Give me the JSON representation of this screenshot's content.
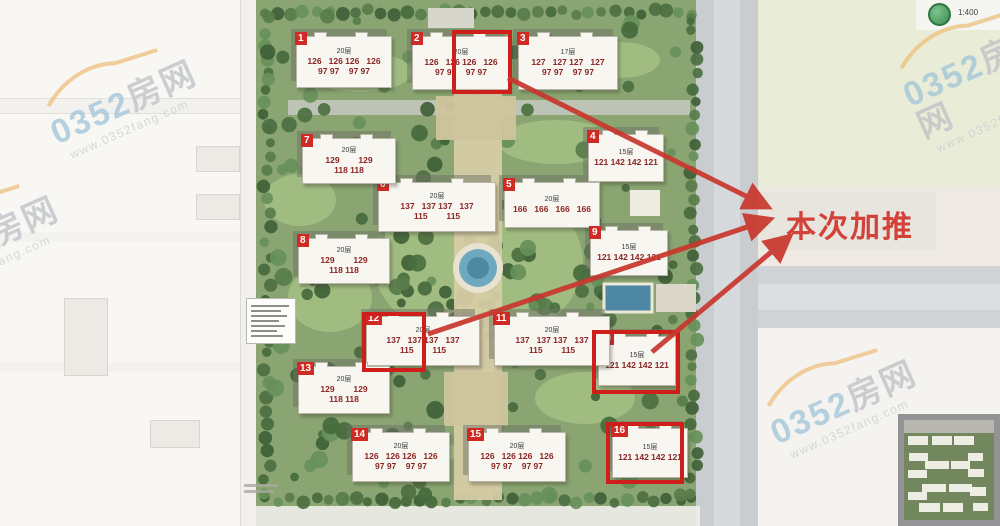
{
  "site_plan": {
    "promo_label": "本次加推",
    "scale_label": "1:400",
    "watermark": {
      "brand_prefix": "0352",
      "brand_suffix": "房网",
      "url": "www.0352fang.com"
    },
    "highlight_color": "#cf1f1a",
    "arrow_color": "#c8372d",
    "buildings": [
      {
        "no": "1",
        "floors": "20层",
        "areas1": "126   126 126   126",
        "areas2": "97 97    97 97",
        "x": 296,
        "y": 36,
        "w": 96,
        "h": 52,
        "highlight": false
      },
      {
        "no": "2",
        "floors": "20层",
        "areas1": "126   126 126   126",
        "areas2": "97 97    97 97",
        "x": 412,
        "y": 36,
        "w": 98,
        "h": 54,
        "highlight": true,
        "box": {
          "x": 452,
          "y": 30,
          "w": 60,
          "h": 64
        }
      },
      {
        "no": "3",
        "floors": "17层",
        "areas1": "127   127 127   127",
        "areas2": "97 97    97 97",
        "x": 518,
        "y": 36,
        "w": 100,
        "h": 54,
        "highlight": false
      },
      {
        "no": "4",
        "floors": "15层",
        "areas1": "121 142 142 121",
        "areas2": "",
        "x": 588,
        "y": 134,
        "w": 76,
        "h": 48,
        "highlight": false
      },
      {
        "no": "5",
        "floors": "20层",
        "areas1": "166   166   166   166",
        "areas2": "",
        "x": 504,
        "y": 182,
        "w": 96,
        "h": 46,
        "highlight": false
      },
      {
        "no": "6",
        "floors": "20层",
        "areas1": "137   137 137   137",
        "areas2": "115        115",
        "x": 378,
        "y": 182,
        "w": 118,
        "h": 50,
        "highlight": false
      },
      {
        "no": "7",
        "floors": "20层",
        "areas1": "129        129",
        "areas2": "118 118",
        "x": 302,
        "y": 138,
        "w": 94,
        "h": 46,
        "highlight": false
      },
      {
        "no": "8",
        "floors": "20层",
        "areas1": "129        129",
        "areas2": "118 118",
        "x": 298,
        "y": 238,
        "w": 92,
        "h": 46,
        "highlight": false
      },
      {
        "no": "9",
        "floors": "15层",
        "areas1": "121 142 142 121",
        "areas2": "",
        "x": 590,
        "y": 230,
        "w": 78,
        "h": 46,
        "highlight": false
      },
      {
        "no": "10",
        "floors": "15层",
        "areas1": "121 142 142 121",
        "areas2": "",
        "x": 598,
        "y": 336,
        "w": 78,
        "h": 50,
        "highlight": true,
        "box": {
          "x": 592,
          "y": 330,
          "w": 88,
          "h": 64
        }
      },
      {
        "no": "11",
        "floors": "20层",
        "areas1": "137   137 137   137",
        "areas2": "115        115",
        "x": 494,
        "y": 316,
        "w": 116,
        "h": 50,
        "highlight": false
      },
      {
        "no": "12",
        "floors": "20层",
        "areas1": "137   137 137   137",
        "areas2": "115        115",
        "x": 366,
        "y": 316,
        "w": 114,
        "h": 50,
        "highlight": true,
        "box": {
          "x": 362,
          "y": 312,
          "w": 64,
          "h": 60
        }
      },
      {
        "no": "13",
        "floors": "20层",
        "areas1": "129        129",
        "areas2": "118 118",
        "x": 298,
        "y": 366,
        "w": 92,
        "h": 48,
        "highlight": false
      },
      {
        "no": "14",
        "floors": "20层",
        "areas1": "126   126 126   126",
        "areas2": "97 97    97 97",
        "x": 352,
        "y": 432,
        "w": 98,
        "h": 50,
        "highlight": false
      },
      {
        "no": "15",
        "floors": "20层",
        "areas1": "126   126 126   126",
        "areas2": "97 97    97 97",
        "x": 468,
        "y": 432,
        "w": 98,
        "h": 50,
        "highlight": false
      },
      {
        "no": "16",
        "floors": "15层",
        "areas1": "121 142 142 121",
        "areas2": "",
        "x": 612,
        "y": 428,
        "w": 76,
        "h": 50,
        "highlight": true,
        "box": {
          "x": 606,
          "y": 422,
          "w": 78,
          "h": 62
        }
      }
    ],
    "arrows": [
      {
        "x1": 508,
        "y1": 78,
        "x2": 766,
        "y2": 206
      },
      {
        "x1": 428,
        "y1": 334,
        "x2": 768,
        "y2": 220
      },
      {
        "x1": 652,
        "y1": 352,
        "x2": 788,
        "y2": 238
      }
    ]
  }
}
